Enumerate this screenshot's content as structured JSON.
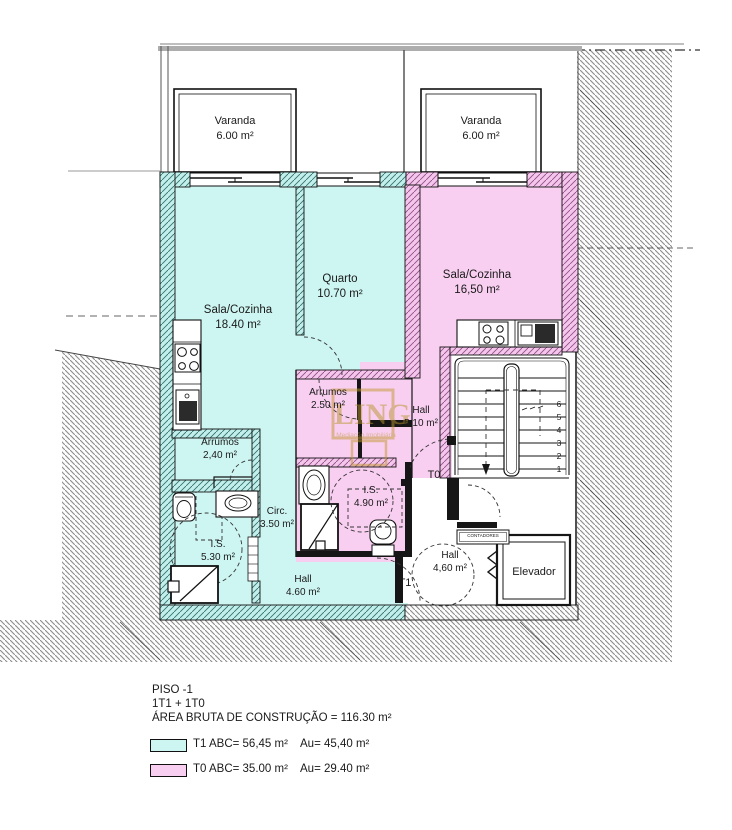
{
  "plan": {
    "balcony_left": {
      "name": "Varanda",
      "area": "6.00 m²"
    },
    "balcony_right": {
      "name": "Varanda",
      "area": "6.00 m²"
    },
    "rooms": {
      "sala_t1": {
        "name": "Sala/Cozinha",
        "area": "18.40 m²"
      },
      "quarto": {
        "name": "Quarto",
        "area": "10.70 m²"
      },
      "sala_t0": {
        "name": "Sala/Cozinha",
        "area": "16,50 m²"
      },
      "arrumos_t0": {
        "name": "Arrumos",
        "area": "2.50 m²"
      },
      "hall_t0": {
        "name": "Hall",
        "area": "5.10 m²"
      },
      "arrumos_t1": {
        "name": "Arrumos",
        "area": "2,40 m²"
      },
      "circ_t1": {
        "name": "Circ.",
        "area": "3.50 m²"
      },
      "is_t1": {
        "name": "I.S.",
        "area": "5.30 m²"
      },
      "is_t0": {
        "name": "I.S.",
        "area": "4.90 m²"
      },
      "hall_t1": {
        "name": "Hall",
        "area": "4.60 m²"
      },
      "hall_common": {
        "name": "Hall",
        "area": "4,60 m²"
      },
      "elevator": {
        "name": "Elevador"
      },
      "meters": {
        "name": "CONTADORES"
      }
    },
    "unit_tags": {
      "t0": "T0",
      "t1": "T1"
    },
    "stairs": {
      "numbers": [
        "1",
        "2",
        "3",
        "4",
        "5",
        "6"
      ]
    },
    "watermark": {
      "text": "LING",
      "subtext": "Mediação Imobiliária"
    }
  },
  "legend": {
    "floor": "PISO -1",
    "composition": "1T1 + 1T0",
    "gross_area": "ÁREA BRUTA DE CONSTRUÇÃO = 116.30 m²",
    "t1_abc": "T1 ABC= 56,45 m²",
    "t1_au": "Au= 45,40 m²",
    "t0_abc": "T0 ABC= 35.00 m²",
    "t0_au": "Au= 29.40 m²"
  },
  "colors": {
    "t1_fill": "#cdf6f3",
    "t0_fill": "#f9cff1",
    "wall_line": "#161616",
    "terrain_hatch": "#8c8c8c",
    "watermark_gold": "#b8962e"
  }
}
